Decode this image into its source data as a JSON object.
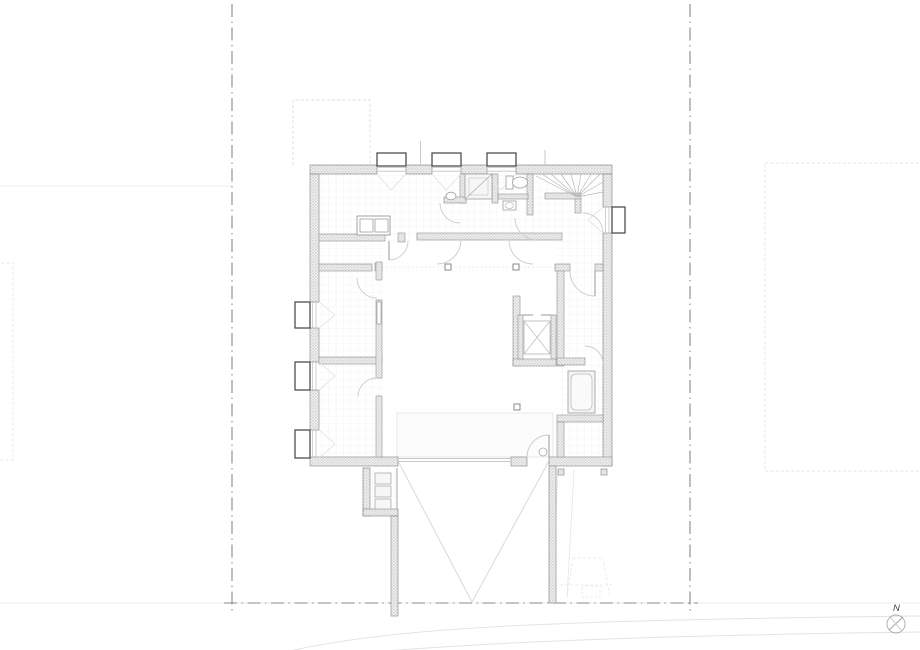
{
  "page": {
    "background": "#ffffff",
    "kind": "architectural-floor-plan"
  },
  "north_arrow": {
    "label": "N"
  },
  "colors": {
    "wall_hatch": "#c9c9c9",
    "wall_edge": "#8f8f8f",
    "window_frame": "#4f4f4f",
    "boundary_line": "#8a8a8a",
    "door_arc": "#cccccc",
    "fixture_line": "#9e9e9e",
    "floor_grid": "#efefef",
    "site_faint": "#e3e3e3",
    "north_mark": "#444444"
  },
  "plan": {
    "window_bays": {
      "top": 3,
      "left": 3,
      "right": 1
    },
    "features": [
      "winder-stair",
      "elevator-shaft",
      "shower",
      "toilet",
      "wash-basin",
      "bathtub",
      "kitchen-unit",
      "meter-cabinets",
      "ramp-marking",
      "structural-columns",
      "void-outline"
    ],
    "site": [
      "property-boundary-dash-dot",
      "neighbor-building-outline-top-left",
      "neighbor-building-outline-right",
      "neighbor-building-outline-left",
      "road-edge-curves",
      "parking-marking",
      "north-arrow"
    ]
  }
}
